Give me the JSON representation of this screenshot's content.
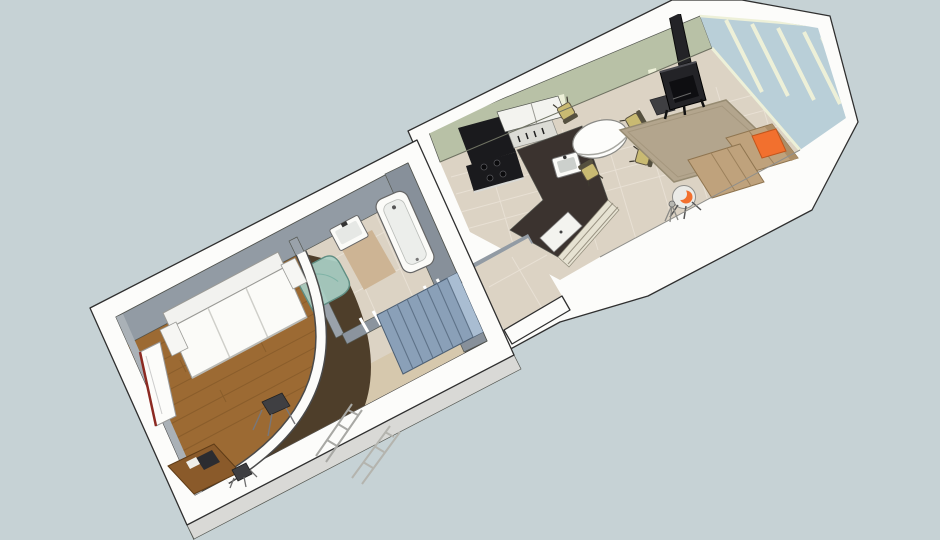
{
  "scene": {
    "description": "SketchUp-style 3D cutaway dollhouse floor-plan render of a two-wing home viewed from above",
    "view": "aerial cutaway perspective, walls sliced at waist height",
    "visible_text": "none",
    "wings": [
      {
        "name": "bedroom-bathroom-wing",
        "rooms": [
          {
            "name": "bedroom",
            "floor": "wood planks",
            "items": [
              "white-sofa-bed",
              "corner-desk",
              "desk-stool",
              "leaning-door-panel-red-trim",
              "dark-stool",
              "ladder-frames"
            ]
          },
          {
            "name": "bathroom",
            "floor": "tile",
            "items": [
              "bathtub",
              "wall-sink",
              "curved-teal-shower"
            ]
          },
          {
            "name": "hallway",
            "floor": "tile and dark carpet",
            "items": [
              "curved-white-wall",
              "staircase-blue",
              "door-frames",
              "landing-strip"
            ]
          }
        ]
      },
      {
        "name": "kitchen-living-wing",
        "rooms": [
          {
            "name": "kitchen",
            "floor": "tile",
            "items": [
              "range-hood",
              "black-range",
              "upper-cabinets",
              "open-shelf",
              "l-shaped-dark-counter",
              "island-sink",
              "cream-cabinet-front",
              "white-appliance"
            ]
          },
          {
            "name": "dining",
            "items": [
              "round-white-table",
              "four-tan-chairs"
            ]
          },
          {
            "name": "living-room",
            "items": [
              "wood-stove",
              "stove-pipe",
              "area-rug",
              "sectional-sofa",
              "orange-cushion",
              "swivel-armchair",
              "floor-lamp",
              "dark-side-cube",
              "glass-door-wall",
              "green-panel-wall"
            ]
          }
        ]
      },
      {
        "name": "connector-landing",
        "rooms": [
          {
            "name": "landing",
            "floor": "tile"
          }
        ]
      }
    ]
  },
  "colors": {
    "background": "#c6d2d5",
    "wall_white": "#fcfcfa",
    "wall_face_light": "#e9e9e6",
    "wall_face_shadow": "#d9d9d6",
    "interior_wall_gray": "#929ba4",
    "interior_wall_gray_dark": "#87909a",
    "interior_wall_gray_light": "#aab1b7",
    "partition_gray": "#8b949e",
    "partition_gray_light": "#9aa2aa",
    "green_wall": "#b8c1a6",
    "cream_trim": "#edf0d8",
    "glass_blue": "#b9cfd8",
    "tile_floor": "#dcd3c4",
    "tile_grout": "#ebe4d8",
    "tan_landing": "#d6c8ad",
    "bath_mat": "#cdb494",
    "wood_floor": "#9c6a33",
    "wood_plank_line": "#7e5526",
    "dark_carpet": "#4e3e2a",
    "stairs_blue": "#8aa0b8",
    "stairs_tread_line": "#5f7389",
    "stairs_top_light": "#a9bdd2",
    "shower_teal": "#a9cfc4",
    "shower_teal_dark": "#5f8d82",
    "fixture_white": "#fbfbf8",
    "fixture_inner": "#eceeeb",
    "counter_dark": "#3b332f",
    "appliance_black": "#1a1a1d",
    "stove_body": "#232327",
    "cabinet_cream": "#e6e2d2",
    "shelf_white": "#f3f3ef",
    "table_white": "#fdfdfb",
    "chair_tan": "#c9ba72",
    "chair_back": "#55503f",
    "rug_tan": "#b3a58d",
    "sofa_tan": "#bfa27c",
    "sofa_back_tan": "#ab8e68",
    "cushion_orange": "#f2702e",
    "armchair_shell": "#ebebe7",
    "white_furniture": "#fbfbf8",
    "desk_wood": "#8a5a2a",
    "door_red": "#8c2a22",
    "metal_gray": "#a8a8a4",
    "dark_item": "#3f3f42"
  }
}
